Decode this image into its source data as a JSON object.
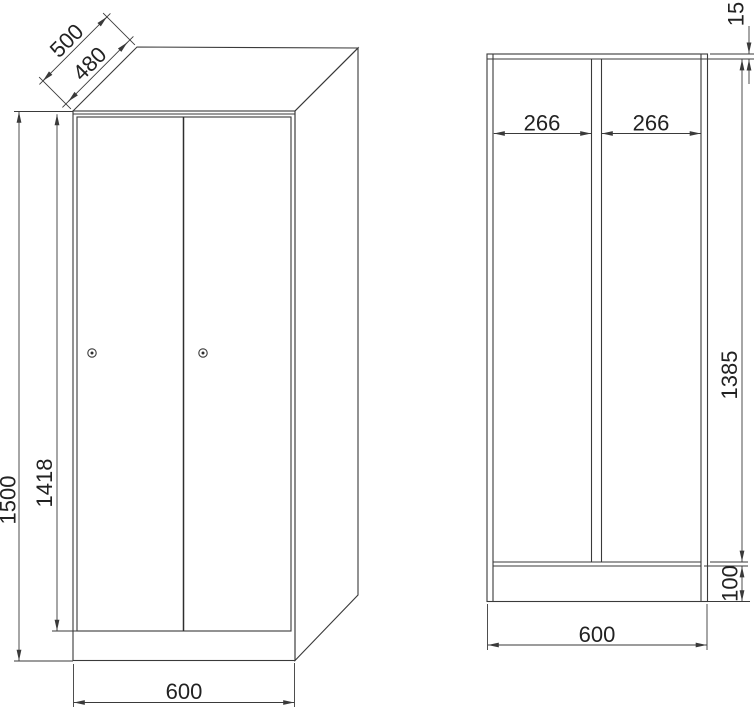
{
  "drawing": {
    "type": "technical-dimension-drawing",
    "subject": "two-door locker wardrobe, front perspective view and front section view",
    "units": "mm",
    "colors": {
      "background": "#ffffff",
      "line": "#3a3a3a",
      "text": "#222222"
    },
    "front_view": {
      "name": "front perspective view",
      "door_count": 2,
      "lock_count": 2,
      "dims": {
        "depth_outer": "500",
        "depth_inner": "480",
        "height_total": "1500",
        "door_height": "1418",
        "width": "600"
      }
    },
    "section_view": {
      "name": "front section view",
      "compartment_count": 2,
      "dims": {
        "compartment_left": "266",
        "compartment_right": "266",
        "top_panel": "15",
        "interior_height": "1385",
        "plinth_height": "100",
        "width": "600"
      }
    }
  }
}
